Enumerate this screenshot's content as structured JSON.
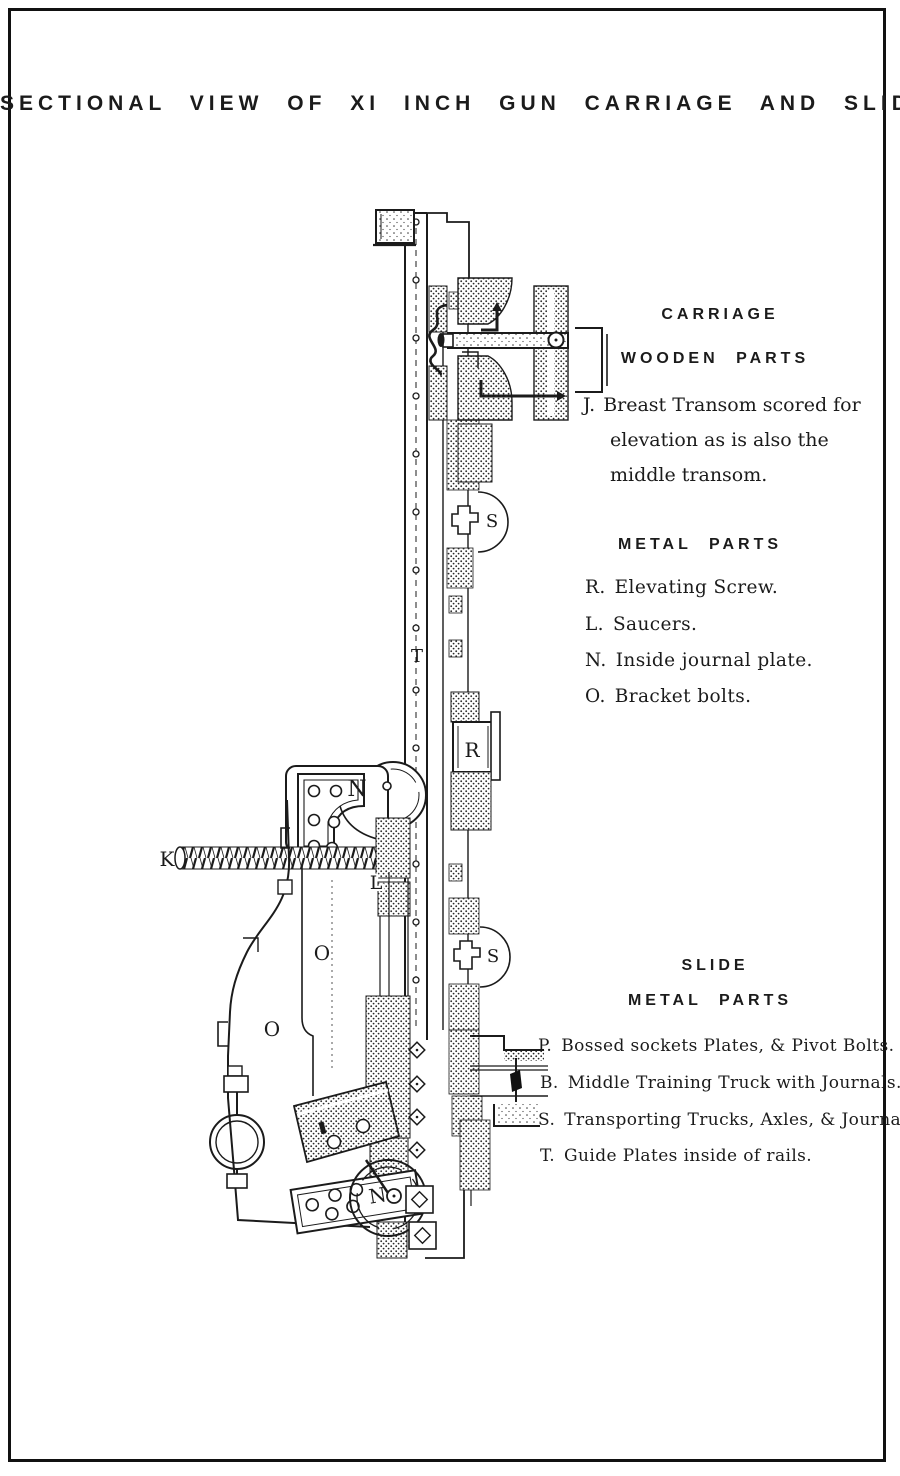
{
  "title": "SECTIONAL VIEW OF XI INCH GUN CARRIAGE AND SLIDE",
  "legend": {
    "carriage": {
      "heading": "CARRIAGE",
      "wooden": {
        "heading": "WOODEN PARTS",
        "item_j": {
          "key": "J.",
          "line1": "Breast Transom scored for",
          "line2": "elevation as is also the",
          "line3": "middle transom."
        }
      },
      "metal": {
        "heading": "METAL PARTS",
        "items": [
          {
            "key": "R.",
            "text": "Elevating Screw."
          },
          {
            "key": "L.",
            "text": "Saucers."
          },
          {
            "key": "N.",
            "text": "Inside journal plate."
          },
          {
            "key": "O.",
            "text": "Bracket bolts."
          }
        ]
      }
    },
    "slide": {
      "heading": "SLIDE",
      "metal": {
        "heading": "METAL PARTS",
        "items": [
          {
            "key": "P.",
            "text": "Bossed sockets Plates, & Pivot Bolts."
          },
          {
            "key": "B.",
            "text": "Middle Training Truck with Journals."
          },
          {
            "key": "S.",
            "text": "Transporting Trucks, Axles, & Journals."
          },
          {
            "key": "T.",
            "text": "Guide Plates inside of rails."
          }
        ]
      }
    }
  },
  "diagram": {
    "labels": {
      "k": "K",
      "t": "T",
      "r": "R",
      "l": "L",
      "n_upper": "N",
      "n_lower": "N",
      "o_upper": "O",
      "o_lower": "O",
      "s_upper": "S",
      "s_lower": "S"
    },
    "colors": {
      "ink": "#1b1b1b",
      "paper": "#ffffff"
    }
  }
}
